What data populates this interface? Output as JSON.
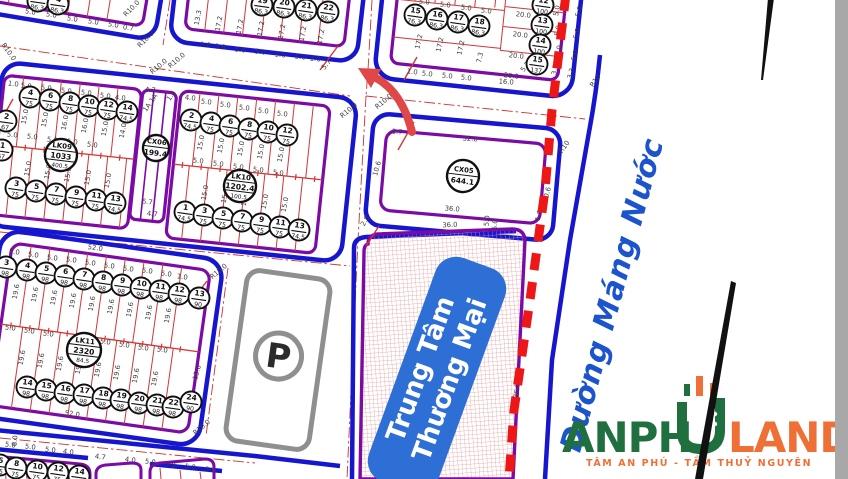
{
  "map": {
    "street_name": "Đường Máng Nước",
    "commercial_center": {
      "line1": "Trung Tâm",
      "line2": "Thương Mại"
    },
    "parking_symbol": "P",
    "colors": {
      "road_blue": "#1616cf",
      "block_purple": "#7c0ba6",
      "lot_red": "#d23535",
      "dashed_red": "#ee1717",
      "hatch_pink": "#e39a9a",
      "label_blue": "#2e6fd6",
      "street_text_blue": "#1b54cc",
      "parking_gray": "#8f8f8f",
      "dim_text": "#3c3c3c"
    },
    "block_circles": [
      {
        "id": "LK09",
        "area": "1033",
        "sub": "400.5",
        "x": 61,
        "y": 155,
        "r": 16
      },
      {
        "id": "CX06",
        "area": "199.4",
        "sub": "",
        "x": 156,
        "y": 148,
        "r": 13
      },
      {
        "id": "LK10",
        "area": "1202.4",
        "sub": "100.5",
        "x": 240,
        "y": 186,
        "r": 16
      },
      {
        "id": "LK11",
        "area": "2320",
        "sub": "84.5",
        "x": 84,
        "y": 350,
        "r": 17
      },
      {
        "id": "CX05",
        "area": "644.1",
        "sub": "",
        "x": 463,
        "y": 176,
        "r": 16
      }
    ],
    "plot_circles": [
      [
        "3",
        "86.3",
        38,
        1
      ],
      [
        "4",
        "86.3",
        58,
        4
      ],
      [
        "19",
        "86.3",
        262,
        5
      ],
      [
        "20",
        "86.3",
        284,
        7
      ],
      [
        "21",
        "86.3",
        306,
        10
      ],
      [
        "22",
        "86.3",
        328,
        12
      ],
      [
        "15",
        "76.3",
        415,
        15
      ],
      [
        "16",
        "86.3",
        437,
        19
      ],
      [
        "17",
        "86.3",
        458,
        22
      ],
      [
        "18",
        "86.3",
        479,
        26
      ],
      [
        "12",
        "100",
        543,
        5
      ],
      [
        "13",
        "100",
        542,
        25
      ],
      [
        "14",
        "100",
        540,
        45
      ],
      [
        "15",
        "137",
        537,
        64
      ],
      [
        "4",
        "75",
        30,
        97
      ],
      [
        "6",
        "75",
        50,
        100
      ],
      [
        "8",
        "75",
        70,
        103
      ],
      [
        "10",
        "75",
        89,
        106
      ],
      [
        "12",
        "75",
        108,
        109
      ],
      [
        "14",
        "74.5",
        127,
        112
      ],
      [
        "2",
        "67",
        6,
        121
      ],
      [
        "1",
        "67",
        2,
        150
      ],
      [
        "3",
        "75",
        16,
        188
      ],
      [
        "5",
        "75",
        36,
        191
      ],
      [
        "7",
        "75",
        56,
        194
      ],
      [
        "9",
        "75",
        76,
        197
      ],
      [
        "11",
        "75",
        96,
        200
      ],
      [
        "13",
        "74.5",
        115,
        203
      ],
      [
        "2",
        "74.5",
        191,
        120
      ],
      [
        "4",
        "75",
        211,
        123
      ],
      [
        "6",
        "75",
        230,
        126
      ],
      [
        "8",
        "75",
        249,
        129
      ],
      [
        "10",
        "75",
        268,
        132
      ],
      [
        "12",
        "75",
        287,
        135
      ],
      [
        "1",
        "74.5",
        185,
        212
      ],
      [
        "3",
        "75",
        204,
        215
      ],
      [
        "5",
        "75",
        223,
        218
      ],
      [
        "7",
        "75",
        242,
        221
      ],
      [
        "9",
        "75",
        261,
        224
      ],
      [
        "11",
        "75",
        280,
        227
      ],
      [
        "13",
        "74.5",
        299,
        230
      ],
      [
        "3",
        "98",
        6,
        267
      ],
      [
        "4",
        "98",
        27,
        270
      ],
      [
        "5",
        "98",
        46,
        273
      ],
      [
        "6",
        "98",
        65,
        276
      ],
      [
        "7",
        "98",
        84,
        279
      ],
      [
        "8",
        "98",
        103,
        282
      ],
      [
        "9",
        "98",
        122,
        285
      ],
      [
        "10",
        "98",
        141,
        288
      ],
      [
        "11",
        "98",
        160,
        291
      ],
      [
        "12",
        "98",
        179,
        294
      ],
      [
        "13",
        "90",
        199,
        298
      ],
      [
        "14",
        "98",
        27,
        387
      ],
      [
        "15",
        "98",
        46,
        390
      ],
      [
        "16",
        "98",
        65,
        393
      ],
      [
        "17",
        "98",
        84,
        395
      ],
      [
        "18",
        "98",
        103,
        398
      ],
      [
        "19",
        "98",
        121,
        400
      ],
      [
        "20",
        "98",
        139,
        403
      ],
      [
        "21",
        "98",
        157,
        405
      ],
      [
        "22",
        "98",
        173,
        407
      ],
      [
        "24",
        "90",
        191,
        402
      ],
      [
        "6",
        "75",
        0,
        465
      ],
      [
        "8",
        "75",
        16,
        468
      ],
      [
        "10",
        "75",
        37,
        471
      ],
      [
        "12",
        "75",
        58,
        473
      ],
      [
        "14",
        "74.5",
        79,
        476
      ]
    ],
    "dim_labels": [
      [
        "5.0",
        30,
        14,
        9
      ],
      [
        "5.0",
        51,
        17,
        9
      ],
      [
        "5.0",
        72,
        21,
        9
      ],
      [
        "5.0",
        93,
        24,
        9
      ],
      [
        "5.0",
        113,
        27,
        9
      ],
      [
        "0.7",
        128,
        30,
        9
      ],
      [
        "R10.0",
        7,
        53,
        55
      ],
      [
        "R10.0",
        147,
        41,
        -45
      ],
      [
        "R10.0",
        160,
        68,
        -40
      ],
      [
        "R10.0",
        133,
        10,
        -45
      ],
      [
        "1.0",
        205,
        47,
        7
      ],
      [
        "5.0",
        220,
        49,
        7
      ],
      [
        "5.0",
        240,
        52,
        7
      ],
      [
        "5.0",
        260,
        54,
        7
      ],
      [
        "5.0",
        280,
        57,
        7
      ],
      [
        "5.0",
        300,
        59,
        7
      ],
      [
        "1.0",
        315,
        61,
        7
      ],
      [
        "5.7",
        328,
        66,
        -50
      ],
      [
        "13.3",
        200,
        18,
        -80
      ],
      [
        "17.2",
        221,
        24,
        -80
      ],
      [
        "17.2",
        242,
        27,
        -80
      ],
      [
        "17.2",
        263,
        29,
        -80
      ],
      [
        "17.2",
        284,
        32,
        -80
      ],
      [
        "17.2",
        305,
        34,
        -80
      ],
      [
        "17.2",
        323,
        37,
        -80
      ],
      [
        "R10.0",
        178,
        62,
        -40
      ],
      [
        "5.0",
        424,
        4,
        7
      ],
      [
        "5.0",
        445,
        7,
        7
      ],
      [
        "5.0",
        466,
        10,
        7
      ],
      [
        "5.0",
        486,
        13,
        7
      ],
      [
        "17.2",
        421,
        42,
        -78
      ],
      [
        "17.2",
        442,
        45,
        -78
      ],
      [
        "17.2",
        463,
        48,
        -78
      ],
      [
        "7.3",
        482,
        58,
        -78
      ],
      [
        "1.0",
        412,
        74,
        6
      ],
      [
        "5.0",
        427,
        76,
        6
      ],
      [
        "5.0",
        447,
        78,
        6
      ],
      [
        "5.0",
        466,
        80,
        6
      ],
      [
        "16.0",
        506,
        84,
        5
      ],
      [
        "5.7",
        527,
        68,
        -55
      ],
      [
        "20.0",
        523,
        17,
        7
      ],
      [
        "20.0",
        520,
        37,
        7
      ],
      [
        "20.0",
        516,
        58,
        7
      ],
      [
        "20.0",
        511,
        78,
        7
      ],
      [
        "5.0",
        559,
        11,
        -80
      ],
      [
        "5.0",
        560,
        31,
        -80
      ],
      [
        "5.0",
        561,
        51,
        -80
      ],
      [
        "3.3",
        557,
        70,
        -80
      ],
      [
        "R10.0",
        385,
        103,
        -40
      ],
      [
        "R10.0",
        350,
        112,
        -40
      ],
      [
        "R10",
        597,
        82,
        -55
      ],
      [
        "5.0",
        581,
        12,
        -75
      ],
      [
        "5.0",
        579,
        34,
        -75
      ],
      [
        "5.0",
        577,
        56,
        -75
      ],
      [
        "3.3",
        573,
        74,
        -75
      ],
      [
        "1.0",
        13,
        86,
        7
      ],
      [
        "5.0",
        26,
        88,
        7
      ],
      [
        "5.0",
        46,
        90,
        7
      ],
      [
        "5.0",
        66,
        93,
        7
      ],
      [
        "5.0",
        86,
        95,
        7
      ],
      [
        "5.0",
        105,
        98,
        7
      ],
      [
        "4.0",
        120,
        100,
        7
      ],
      [
        "4.7",
        150,
        92,
        7
      ],
      [
        "1A 1A",
        152,
        104,
        -55
      ],
      [
        "1.4",
        173,
        97,
        -55
      ],
      [
        "4.0",
        190,
        100,
        7
      ],
      [
        "15.0",
        27,
        117,
        -80
      ],
      [
        "15.0",
        47,
        120,
        -80
      ],
      [
        "16.0",
        67,
        123,
        -80
      ],
      [
        "16.0",
        87,
        126,
        -80
      ],
      [
        "15.0",
        107,
        129,
        -80
      ],
      [
        "14.0",
        125,
        131,
        -80
      ],
      [
        "5.0",
        12,
        137,
        7
      ],
      [
        "5.0",
        32,
        139,
        7
      ],
      [
        "5.0",
        52,
        142,
        7
      ],
      [
        "5.0",
        72,
        144,
        7
      ],
      [
        "5.0",
        92,
        147,
        7
      ],
      [
        "15.0",
        30,
        169,
        -80
      ],
      [
        "15.0",
        50,
        172,
        -80
      ],
      [
        "15.0",
        70,
        175,
        -80
      ],
      [
        "15.0",
        90,
        178,
        -80
      ],
      [
        "15.0",
        110,
        181,
        -80
      ],
      [
        "6.7",
        147,
        204,
        7
      ],
      [
        "4.7",
        152,
        216,
        7
      ],
      [
        "5.0",
        206,
        104,
        7
      ],
      [
        "5.0",
        225,
        107,
        7
      ],
      [
        "5.0",
        244,
        110,
        7
      ],
      [
        "5.0",
        263,
        113,
        7
      ],
      [
        "5.0",
        282,
        116,
        7
      ],
      [
        "15.0",
        203,
        143,
        -80
      ],
      [
        "15.0",
        223,
        146,
        -80
      ],
      [
        "15.0",
        243,
        149,
        -80
      ],
      [
        "15.0",
        263,
        152,
        -80
      ],
      [
        "15.0",
        283,
        155,
        -80
      ],
      [
        "5.0",
        198,
        163,
        7
      ],
      [
        "5.0",
        218,
        166,
        7
      ],
      [
        "5.0",
        238,
        169,
        7
      ],
      [
        "5.0",
        258,
        172,
        7
      ],
      [
        "5.0",
        278,
        175,
        7
      ],
      [
        "15.0",
        207,
        193,
        -80
      ],
      [
        "15.0",
        227,
        196,
        -80
      ],
      [
        "15.0",
        247,
        199,
        -80
      ],
      [
        "15.0",
        267,
        202,
        -80
      ],
      [
        "15.0",
        287,
        205,
        -80
      ],
      [
        "52.0",
        95,
        250,
        8
      ],
      [
        "5.0",
        14,
        254,
        8
      ],
      [
        "5.0",
        33,
        257,
        8
      ],
      [
        "5.0",
        52,
        260,
        8
      ],
      [
        "5.0",
        71,
        262,
        8
      ],
      [
        "5.0",
        90,
        265,
        8
      ],
      [
        "5.0",
        109,
        268,
        8
      ],
      [
        "5.0",
        128,
        271,
        8
      ],
      [
        "5.0",
        147,
        273,
        8
      ],
      [
        "5.0",
        166,
        276,
        8
      ],
      [
        "1.0",
        182,
        279,
        8
      ],
      [
        "19.6",
        18,
        292,
        -80
      ],
      [
        "19.6",
        37,
        295,
        -80
      ],
      [
        "19.6",
        56,
        298,
        -80
      ],
      [
        "19.6",
        75,
        301,
        -80
      ],
      [
        "19.6",
        94,
        304,
        -80
      ],
      [
        "19.6",
        113,
        307,
        -80
      ],
      [
        "19.6",
        132,
        310,
        -80
      ],
      [
        "19.6",
        151,
        313,
        -80
      ],
      [
        "19.6",
        170,
        316,
        -80
      ],
      [
        "5.0",
        10,
        330,
        8
      ],
      [
        "5.0",
        29,
        333,
        8
      ],
      [
        "5.0",
        48,
        336,
        8
      ],
      [
        "5.0",
        105,
        344,
        8
      ],
      [
        "5.0",
        124,
        347,
        8
      ],
      [
        "5.0",
        143,
        350,
        8
      ],
      [
        "5.0",
        162,
        352,
        8
      ],
      [
        "19.6",
        24,
        358,
        -80
      ],
      [
        "19.6",
        43,
        361,
        -80
      ],
      [
        "19.6",
        62,
        364,
        -80
      ],
      [
        "19.6",
        81,
        367,
        -80
      ],
      [
        "19.6",
        100,
        370,
        -80
      ],
      [
        "19.6",
        119,
        373,
        -80
      ],
      [
        "19.6",
        138,
        376,
        -80
      ],
      [
        "19.6",
        157,
        379,
        -80
      ],
      [
        "52.0",
        72,
        416,
        8
      ],
      [
        "15.6",
        206,
        304,
        -75
      ],
      [
        "15.6",
        199,
        373,
        -75
      ],
      [
        "R10.0",
        220,
        273,
        -40
      ],
      [
        "R10.0",
        203,
        429,
        -40
      ],
      [
        "6.0",
        17,
        441,
        -85
      ],
      [
        "5.7",
        397,
        134,
        5
      ],
      [
        "32.0",
        470,
        141,
        5
      ],
      [
        "10.6",
        379,
        169,
        -75
      ],
      [
        "10.6",
        549,
        195,
        -75
      ],
      [
        "36.0",
        452,
        211,
        5
      ],
      [
        "5.0",
        489,
        221,
        -85
      ],
      [
        "1.8",
        541,
        216,
        -75
      ],
      [
        "R10",
        566,
        148,
        -55
      ],
      [
        "36.0",
        450,
        227,
        -3
      ],
      [
        "5.0",
        497,
        225,
        -85
      ],
      [
        "2.8",
        367,
        222,
        -60
      ],
      [
        "76.0",
        519,
        391,
        -83
      ],
      [
        "5.0",
        10,
        447,
        8
      ],
      [
        "5.0",
        30,
        449,
        8
      ],
      [
        "5.0",
        50,
        452,
        8
      ],
      [
        "4.0",
        68,
        454,
        8
      ],
      [
        "4.7",
        100,
        459,
        8
      ],
      [
        "4.0",
        130,
        462,
        8
      ],
      [
        "5.0",
        150,
        464,
        8
      ],
      [
        "5.0",
        170,
        467,
        8
      ],
      [
        "5.0",
        190,
        469,
        8
      ],
      [
        "5.0",
        210,
        472,
        8
      ]
    ]
  },
  "logo": {
    "text_green": "ANPH",
    "text_land": "LAND",
    "tagline": "TÂM AN PHÚ - TẦM THUỶ NGUYÊN",
    "green": "#206f3f",
    "orange": "#ef7036"
  }
}
